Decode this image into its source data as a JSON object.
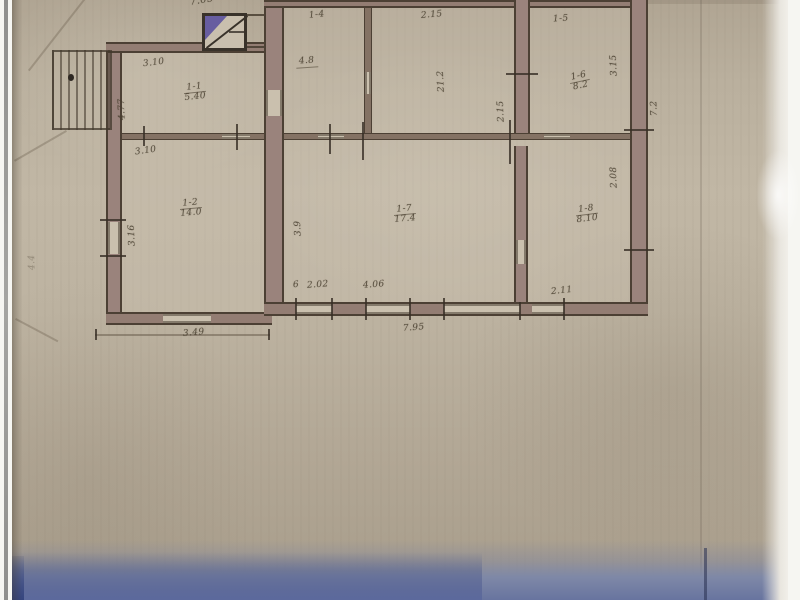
{
  "document": {
    "kind": "scanned floor plan photo",
    "visible_text_language": "handwritten numerals"
  },
  "colors": {
    "paper": "#beb3a1",
    "wall_outline": "#4c4034",
    "wall_fill_pink": "#9a837c",
    "wall_fill_brown": "#847264",
    "ink": "#4e4538",
    "stove_hatch": "#564b9e",
    "scan_margin": "#f6f6f2",
    "table_band_dark": "#5c699c",
    "table_band_light": "#8b93a9"
  },
  "plan": {
    "rooms": [
      {
        "id": "1-1",
        "area": "5.40"
      },
      {
        "id": "1-2",
        "area": "14.0"
      },
      {
        "id": "1-7",
        "area": "17.4"
      },
      {
        "id": "1-6",
        "area": "8.2"
      },
      {
        "id": "1-8",
        "area": "8.10"
      }
    ],
    "room_tags": [
      {
        "text": "1-4"
      },
      {
        "text": "1-5"
      }
    ],
    "area_notes": [
      {
        "text": "4.8"
      },
      {
        "text": "21.2"
      }
    ],
    "dimensions": [
      {
        "text": "7.05"
      },
      {
        "text": "3.10"
      },
      {
        "text": "4.77"
      },
      {
        "text": "3.10"
      },
      {
        "text": "3.16"
      },
      {
        "text": "3.49"
      },
      {
        "text": "2.15"
      },
      {
        "text": "2.15"
      },
      {
        "text": "3.15"
      },
      {
        "text": "3.9"
      },
      {
        "text": "2.08"
      },
      {
        "text": "6"
      },
      {
        "text": "2.02"
      },
      {
        "text": "4.06"
      },
      {
        "text": "2.11"
      },
      {
        "text": "7.95"
      },
      {
        "text": "7.2"
      },
      {
        "text": "4.4"
      }
    ]
  }
}
